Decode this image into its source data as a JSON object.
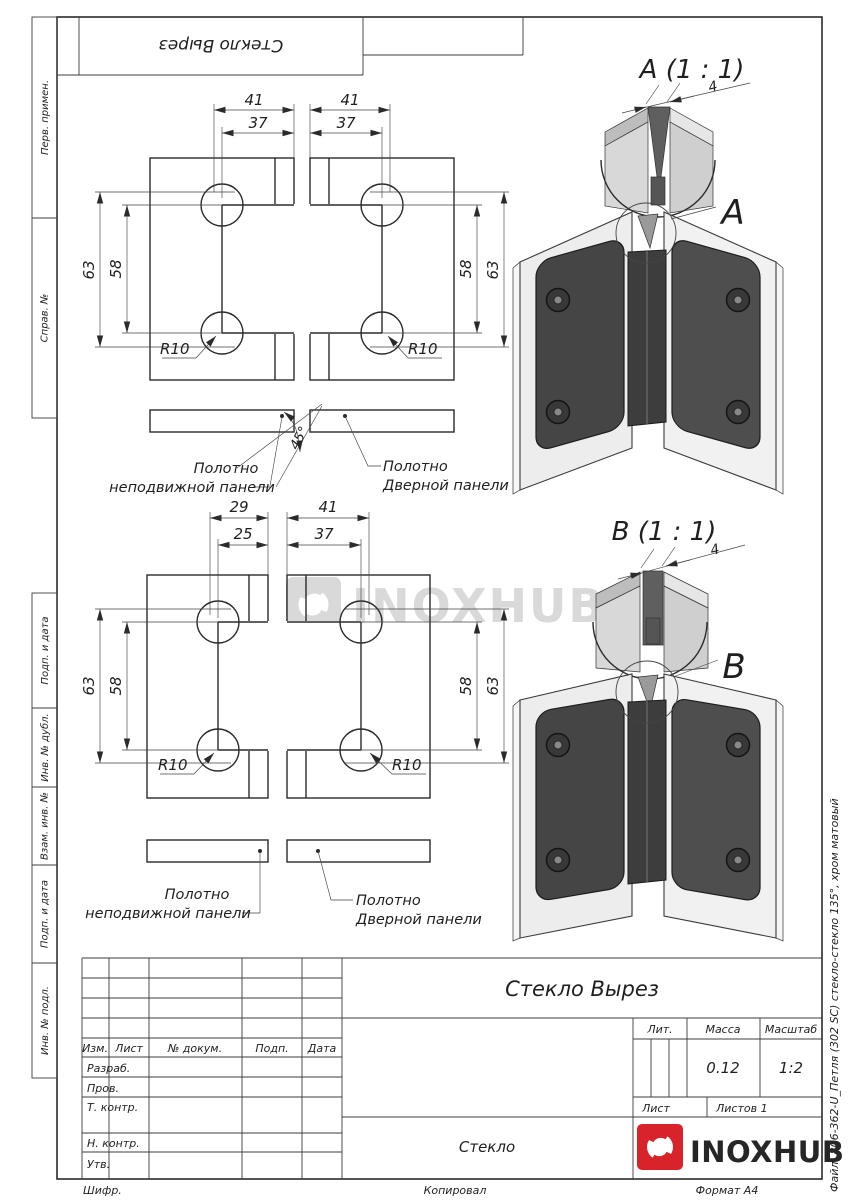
{
  "sheet": {
    "top_stamp": {
      "mirrored_title": "Стекло Вырез"
    },
    "left_margin_labels": [
      "Перв. примен.",
      "Справ. №",
      "Подп. и дата",
      "Инв. № дубл.",
      "Взам. инв. №",
      "Подп. и дата",
      "Инв. № подл."
    ],
    "right_margin_file_label": "Файл: 806-362-U_Петля (302 SC) стекло-стекло 135°, хром матовый",
    "footer": {
      "code_label": "Шифр.",
      "copied_label": "Копировал",
      "format_label": "Формат А4"
    }
  },
  "watermark": {
    "brand": "INOXHUB"
  },
  "view_top": {
    "dim_out_left": "41",
    "dim_in_left": "37",
    "dim_out_right": "41",
    "dim_in_right": "37",
    "dim_h_out_left": "63",
    "dim_h_in_left": "58",
    "dim_h_in_right": "58",
    "dim_h_out_right": "63",
    "radius_left": "R10",
    "radius_right": "R10",
    "bevel_angle": "45°",
    "fixed_panel_label_1": "Полотно",
    "fixed_panel_label_2": "неподвижной панели",
    "door_panel_label_1": "Полотно",
    "door_panel_label_2": "Дверной панели"
  },
  "view_bottom": {
    "dim_out_left": "29",
    "dim_in_left": "25",
    "dim_out_right": "41",
    "dim_in_right": "37",
    "dim_h_out_left": "63",
    "dim_h_in_left": "58",
    "dim_h_in_right": "58",
    "dim_h_out_right": "63",
    "radius_left": "R10",
    "radius_right": "R10",
    "fixed_panel_label_1": "Полотно",
    "fixed_panel_label_2": "неподвижной панели",
    "door_panel_label_1": "Полотно",
    "door_panel_label_2": "Дверной панели"
  },
  "detail_a": {
    "title": "A (1 : 1)",
    "gap_dim": "4",
    "callout_letter": "A"
  },
  "detail_b": {
    "title": "B (1 : 1)",
    "gap_dim": "4",
    "callout_letter": "B"
  },
  "title_block": {
    "doc_title": "Стекло Вырез",
    "material": "Стекло",
    "col_izm": "Изм.",
    "col_list": "Лист",
    "col_ndokum": "№ докум.",
    "col_podp": "Подп.",
    "col_data": "Дата",
    "row_razrab": "Разраб.",
    "row_prov": "Пров.",
    "row_tkontr": "Т. контр.",
    "row_nkontr": "Н. контр.",
    "row_utv": "Утв.",
    "lit_label": "Лит.",
    "mass_label": "Масса",
    "scale_label": "Масштаб",
    "mass_value": "0.12",
    "scale_value": "1:2",
    "sheet_label": "Лист",
    "sheets_label": "Листов 1",
    "brand": "INOXHUB"
  },
  "colors": {
    "brand_red": "#d8232a",
    "line": "#2f2f2f",
    "watermark": "#d9d9d9"
  }
}
